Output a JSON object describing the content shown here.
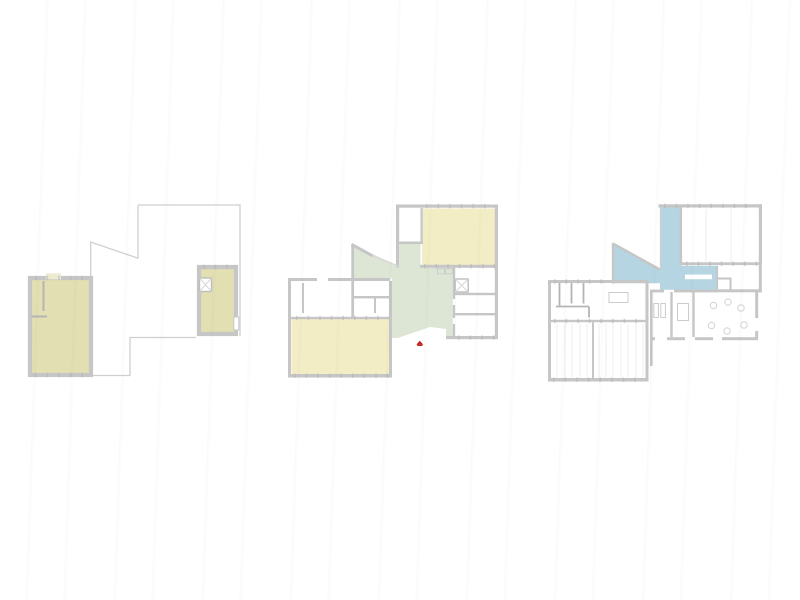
{
  "canvas": {
    "background": "#ffffff"
  },
  "colors": {
    "outline": "#cfcfcf",
    "wall": "#c6c6c6",
    "wall_medium": "#b5b5b5",
    "wall_thin": "#d6d6d6",
    "beige": "#e2dfb2",
    "beige_light": "#edebcf",
    "yellow": "#f2edc5",
    "green": "#dde6d5",
    "blue": "#b4d5e1",
    "red": "#c2221c",
    "fixture": "#cccccc",
    "faint": "#ececec",
    "white": "#ffffff"
  },
  "plans": [
    {
      "id": "plan-left"
    },
    {
      "id": "plan-center"
    },
    {
      "id": "plan-right"
    }
  ],
  "marker": {
    "type": "entrance-arrow"
  }
}
